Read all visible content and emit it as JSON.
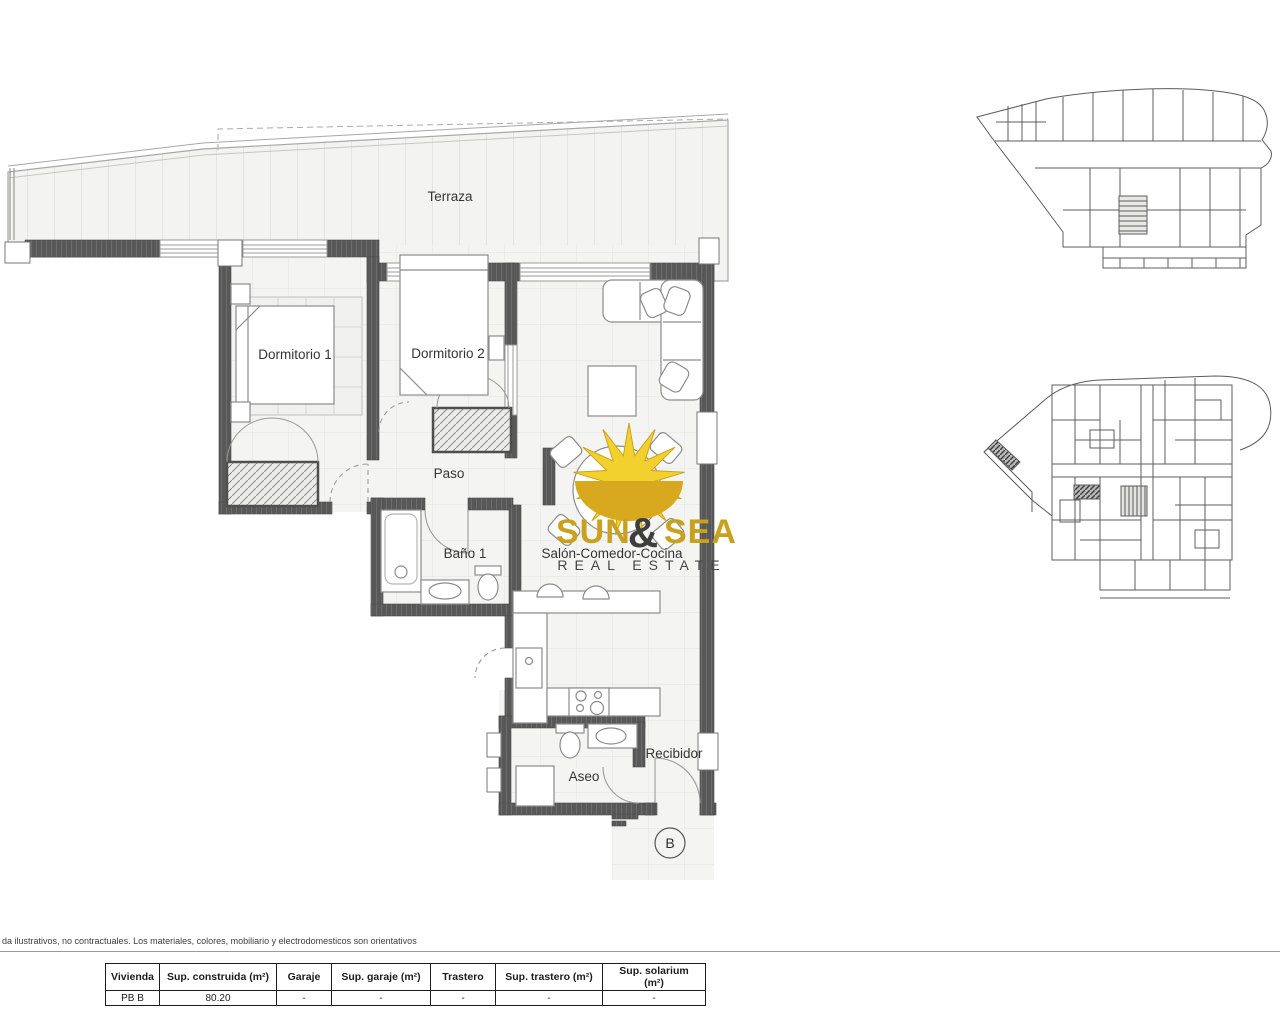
{
  "plan": {
    "rooms": {
      "terraza": "Terraza",
      "dormitorio1": "Dormitorio 1",
      "dormitorio2": "Dormitorio 2",
      "paso": "Paso",
      "bano1": "Baño 1",
      "salon": "Salón-Comedor-Cocina",
      "aseo": "Aseo",
      "recibidor": "Recibidor"
    },
    "unit_label": "B"
  },
  "logo": {
    "word1": "SUN",
    "ampersand": "&",
    "word2": "SEA",
    "tagline": "REAL ESTATE"
  },
  "colors": {
    "gold_text": "#c9a11d",
    "sun_yellow": "#f2d12e",
    "sun_gold": "#d8a81f",
    "amp_dark": "#3e3e3e",
    "tagline_dark": "#474747",
    "wall_gray": "#585858"
  },
  "disclaimer": "da ilustrativos, no contractuales. Los materiales, colores, mobiliario y electrodomesticos son orientativos",
  "table": {
    "headers": [
      "Vivienda",
      "Sup. construida (m²)",
      "Garaje",
      "Sup. garaje (m²)",
      "Trastero",
      "Sup. trastero (m²)",
      "Sup. solarium (m²)"
    ],
    "rows": [
      [
        "PB B",
        "80.20",
        "-",
        "-",
        "-",
        "-",
        "-"
      ]
    ]
  }
}
